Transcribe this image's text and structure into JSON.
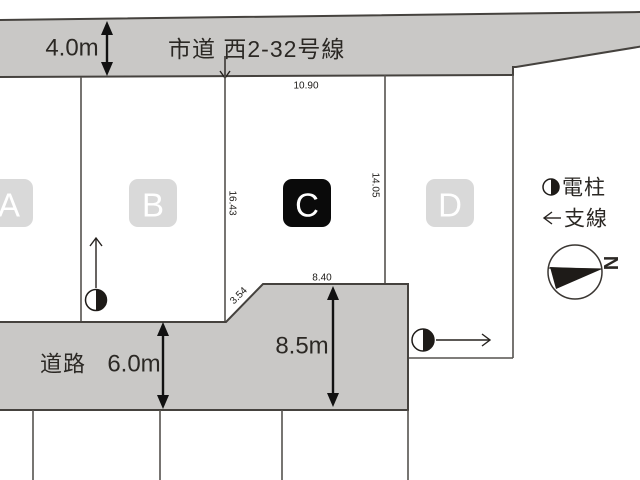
{
  "colors": {
    "road_fill": "#c9c8c6",
    "badge_fill": "#d9d9d9",
    "badge_c_fill": "#0a0a0a",
    "badge_text": "#ffffff"
  },
  "top_road": {
    "name": "市道 西2-32号線",
    "width_label": "4.0m"
  },
  "bottom_road": {
    "name": "道路",
    "width_label": "6.0m",
    "pocket_depth_label": "8.5m"
  },
  "lots": [
    {
      "id": "A"
    },
    {
      "id": "B"
    },
    {
      "id": "C"
    },
    {
      "id": "D"
    }
  ],
  "dimensions": {
    "lot_c_frontage": "10.90",
    "lot_bc_boundary_depth": "16.43",
    "lot_cd_boundary_depth": "14.05",
    "pocket_top_width": "8.40",
    "diagonal_edge": "3.54"
  },
  "legend": {
    "utility_pole_label": "電柱",
    "guy_wire_label": "支線",
    "north_label": "N"
  }
}
